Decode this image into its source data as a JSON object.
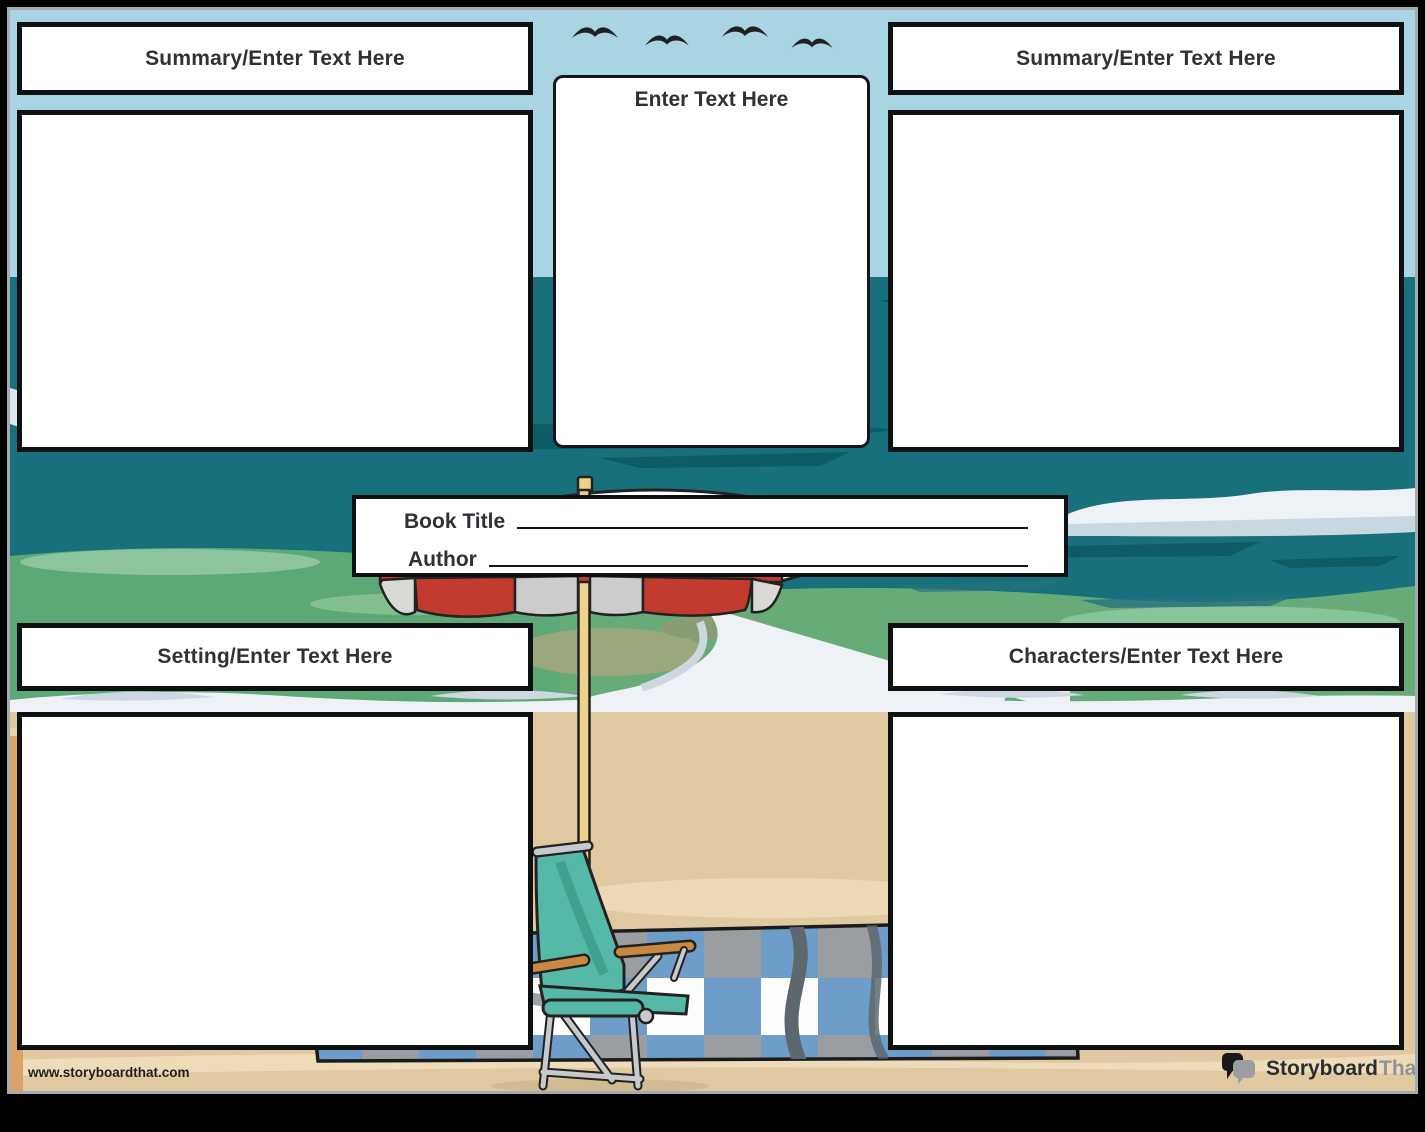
{
  "fields": {
    "summary_left": {
      "label": "Summary/Enter Text Here",
      "value": ""
    },
    "center": {
      "label": "Enter Text Here",
      "value": ""
    },
    "summary_right": {
      "label": "Summary/Enter Text Here",
      "value": ""
    },
    "setting": {
      "label": "Setting/Enter Text Here",
      "value": ""
    },
    "characters": {
      "label": "Characters/Enter Text Here",
      "value": ""
    }
  },
  "title_box": {
    "book_title_label": "Book Title",
    "book_title_value": "",
    "author_label": "Author",
    "author_value": ""
  },
  "footer": {
    "website": "www.storyboardthat.com",
    "logo_part1": "Storyboard",
    "logo_part2": "That"
  },
  "icons": {
    "birds": "seagull-icon",
    "logo_mark": "speech-bubbles-icon"
  },
  "colors": {
    "sky": "#a9d4e1",
    "ocean": "#17707b",
    "ocean_streak": "#0d5b65",
    "shallow_green": "#5ca876",
    "foam": "#eef2f6",
    "sand": "#e0c8a1",
    "umbrella_red": "#c23b2e",
    "umbrella_pole": "#eed289",
    "chair_teal": "#56b9a7",
    "armrest_wood": "#c8883f",
    "blanket_blue": "#6f9dc9",
    "blanket_gray": "#9a9da1",
    "text": "#2e3236",
    "logo_gray": "#8f9396"
  }
}
